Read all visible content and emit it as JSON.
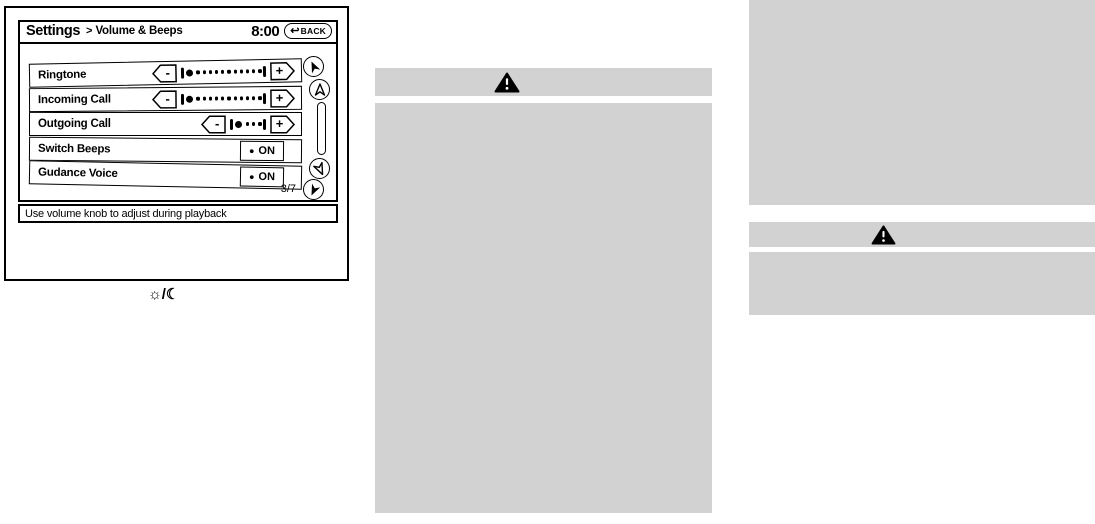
{
  "colors": {
    "ink": "#000000",
    "paper": "#ffffff",
    "placeholder": "#d2d2d2"
  },
  "icons": {
    "back_arrow": "↩",
    "on_dot": "●"
  },
  "figure": {
    "screen": {
      "header": {
        "title": "Settings",
        "separator": ">",
        "subtitle": "Volume & Beeps",
        "clock": "8:00",
        "back_label": "BACK"
      },
      "list": {
        "minus_label": "-",
        "plus_label": "+",
        "rows": [
          {
            "label": "Ringtone",
            "control": "slider",
            "level_dots": 11
          },
          {
            "label": "Incoming Call",
            "control": "slider",
            "level_dots": 11
          },
          {
            "label": "Outgoing Call",
            "control": "slider",
            "level_dots": 3
          },
          {
            "label": "Switch Beeps",
            "control": "toggle",
            "value": "ON"
          },
          {
            "label": "Gudance Voice",
            "control": "toggle",
            "value": "ON"
          }
        ],
        "page_indicator": "3/7"
      },
      "status_bar": "Use volume knob to adjust during playback"
    },
    "day_night_icon": "☼/☾"
  }
}
